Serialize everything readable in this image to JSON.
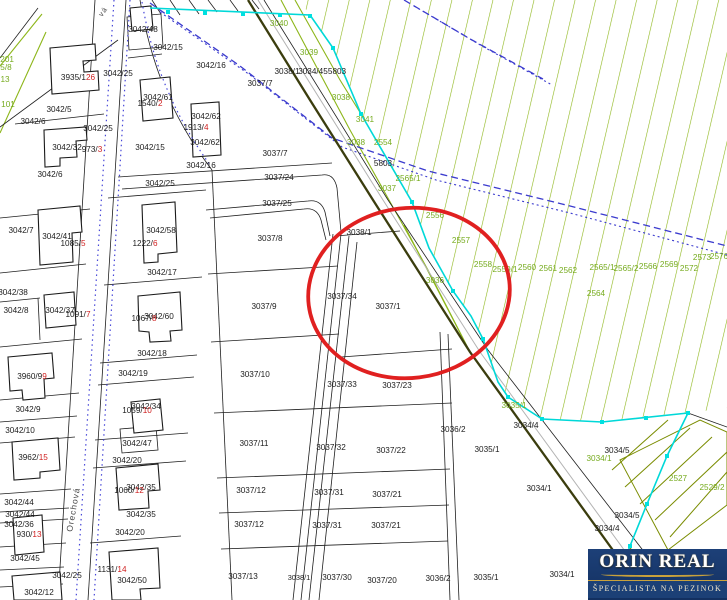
{
  "colors": {
    "parcel_line": "#1f1f1f",
    "forest_hatch": "#8db61a",
    "forest_label_green": "#76ab1e",
    "building_number_red": "#cf1f1f",
    "cadastre_boundary_cyan": "#00d8d8",
    "utility_dashed_blue": "#3b3bce",
    "road_dotted_blue": "#4646d8",
    "highlight_red": "#e02020",
    "vineyard_olive": "#7a8c00",
    "dark_path": "#3b3d0e",
    "logo_navy": "#1d4078",
    "logo_gold": "#c9a23c"
  },
  "highlight": {
    "cx": 409,
    "cy": 293,
    "rx": 101,
    "ry": 85,
    "rotation": -7,
    "color": "#e02020"
  },
  "logo": {
    "title": "ORIN REAL",
    "subtitle": "ŠPECIALISTA NA PEZINOK"
  },
  "map": {
    "labels": [
      {
        "t": "3042/48",
        "x": 143,
        "y": 32
      },
      {
        "t": "3042/15",
        "x": 168,
        "y": 50
      },
      {
        "t": "3042/16",
        "x": 211,
        "y": 68
      },
      {
        "t": "3042/25",
        "x": 118,
        "y": 76
      },
      {
        "t": "3042/5",
        "x": 59,
        "y": 112
      },
      {
        "t": "3042/6",
        "x": 33,
        "y": 124
      },
      {
        "t": "3042/25",
        "x": 98,
        "y": 131
      },
      {
        "t": "3042/61",
        "x": 158,
        "y": 100
      },
      {
        "t": "1540/",
        "rd": "2",
        "x": 150,
        "y": 106,
        "c": "m"
      },
      {
        "t": "3042/62",
        "x": 206,
        "y": 119
      },
      {
        "t": "1913/",
        "rd": "4",
        "x": 196,
        "y": 130,
        "c": "m"
      },
      {
        "t": "3042/62",
        "x": 205,
        "y": 145
      },
      {
        "t": "3042/15",
        "x": 150,
        "y": 150
      },
      {
        "t": "3042/16",
        "x": 201,
        "y": 168
      },
      {
        "t": "3042/6",
        "x": 50,
        "y": 177
      },
      {
        "t": "3042/25",
        "x": 160,
        "y": 186
      },
      {
        "t": "3935/1",
        "rd": "26",
        "x": 78,
        "y": 80,
        "c": "m"
      },
      {
        "t": "3042/32",
        "x": 67,
        "y": 150
      },
      {
        "t": "973/",
        "rd": "3",
        "x": 92,
        "y": 152,
        "c": "m"
      },
      {
        "t": "3037/7",
        "x": 260,
        "y": 86
      },
      {
        "t": "3038/1",
        "x": 287,
        "y": 74
      },
      {
        "t": "3034/45",
        "x": 313,
        "y": 74
      },
      {
        "t": "5803",
        "x": 337,
        "y": 74
      },
      {
        "t": "3037/7",
        "x": 275,
        "y": 156
      },
      {
        "t": "5803",
        "x": 383,
        "y": 166
      },
      {
        "t": "3037/24",
        "x": 279,
        "y": 180
      },
      {
        "t": "3037/25",
        "x": 277,
        "y": 206
      },
      {
        "t": "3042/7",
        "x": 21,
        "y": 233
      },
      {
        "t": "3042/41",
        "x": 57,
        "y": 239
      },
      {
        "t": "1085/",
        "rd": "5",
        "x": 73,
        "y": 246,
        "c": "m"
      },
      {
        "t": "3042/58",
        "x": 161,
        "y": 233
      },
      {
        "t": "1222/",
        "rd": "6",
        "x": 145,
        "y": 246,
        "c": "m"
      },
      {
        "t": "3042/17",
        "x": 162,
        "y": 275
      },
      {
        "t": "3042/38",
        "x": 13,
        "y": 295
      },
      {
        "t": "3042/8",
        "x": 16,
        "y": 313
      },
      {
        "t": "3042/37",
        "x": 60,
        "y": 313
      },
      {
        "t": "1091/",
        "rd": "7",
        "x": 78,
        "y": 317,
        "c": "m"
      },
      {
        "t": "3042/60",
        "x": 159,
        "y": 319
      },
      {
        "t": "1067/",
        "rd": "8",
        "x": 144,
        "y": 321,
        "c": "m"
      },
      {
        "t": "3042/18",
        "x": 152,
        "y": 356
      },
      {
        "t": "3042/19",
        "x": 133,
        "y": 376
      },
      {
        "t": "3960/9",
        "rd": "9",
        "x": 32,
        "y": 379,
        "c": "m"
      },
      {
        "t": "3042/9",
        "x": 28,
        "y": 412
      },
      {
        "t": "3042/34",
        "x": 146,
        "y": 409
      },
      {
        "t": "1059/",
        "rd": "10",
        "x": 137,
        "y": 413,
        "c": "m"
      },
      {
        "t": "3042/10",
        "x": 20,
        "y": 433
      },
      {
        "t": "3042/47",
        "x": 137,
        "y": 446
      },
      {
        "t": "3042/20",
        "x": 127,
        "y": 463
      },
      {
        "t": "3962/",
        "rd": "15",
        "x": 33,
        "y": 460,
        "c": "m"
      },
      {
        "t": "3042/35",
        "x": 141,
        "y": 490
      },
      {
        "t": "1060/",
        "rd": "12",
        "x": 129,
        "y": 493,
        "c": "m"
      },
      {
        "t": "3042/35",
        "x": 141,
        "y": 517
      },
      {
        "t": "3042/44",
        "x": 19,
        "y": 505
      },
      {
        "t": "3042/44",
        "x": 20,
        "y": 517
      },
      {
        "t": "3042/36",
        "x": 19,
        "y": 527
      },
      {
        "t": "930/",
        "rd": "13",
        "x": 29,
        "y": 537,
        "c": "m"
      },
      {
        "t": "3042/45",
        "x": 25,
        "y": 561
      },
      {
        "t": "3042/20",
        "x": 130,
        "y": 535
      },
      {
        "t": "1131/",
        "rd": "14",
        "x": 112,
        "y": 572,
        "c": "m"
      },
      {
        "t": "3042/25",
        "x": 67,
        "y": 578
      },
      {
        "t": "3042/50",
        "x": 132,
        "y": 583
      },
      {
        "t": "3042/12",
        "x": 39,
        "y": 595
      },
      {
        "t": "3037/8",
        "x": 270,
        "y": 241
      },
      {
        "t": "3038/1",
        "x": 359,
        "y": 235
      },
      {
        "t": "3037/34",
        "x": 342,
        "y": 299
      },
      {
        "t": "3037/1",
        "x": 388,
        "y": 309
      },
      {
        "t": "3037/9",
        "x": 264,
        "y": 309
      },
      {
        "t": "3037/10",
        "x": 255,
        "y": 377
      },
      {
        "t": "3037/33",
        "x": 342,
        "y": 387
      },
      {
        "t": "3037/23",
        "x": 397,
        "y": 388
      },
      {
        "t": "3037/11",
        "x": 254,
        "y": 446
      },
      {
        "t": "3037/32",
        "x": 331,
        "y": 450
      },
      {
        "t": "3037/22",
        "x": 391,
        "y": 453
      },
      {
        "t": "3037/12",
        "x": 251,
        "y": 493
      },
      {
        "t": "3037/31",
        "x": 329,
        "y": 495
      },
      {
        "t": "3037/21",
        "x": 387,
        "y": 497
      },
      {
        "t": "3037/12",
        "x": 249,
        "y": 527
      },
      {
        "t": "3037/31",
        "x": 327,
        "y": 528
      },
      {
        "t": "3037/21",
        "x": 386,
        "y": 528
      },
      {
        "t": "3037/13",
        "x": 243,
        "y": 579
      },
      {
        "t": "3038/1",
        "x": 299,
        "y": 580,
        "s": 7.4
      },
      {
        "t": "3037/30",
        "x": 337,
        "y": 580
      },
      {
        "t": "3037/20",
        "x": 382,
        "y": 583
      },
      {
        "t": "3036/2",
        "x": 453,
        "y": 432
      },
      {
        "t": "3036/2",
        "x": 438,
        "y": 581
      },
      {
        "t": "3035/1",
        "x": 487,
        "y": 452
      },
      {
        "t": "3035/1",
        "x": 486,
        "y": 580
      },
      {
        "t": "3034/4",
        "x": 526,
        "y": 428
      },
      {
        "t": "3034/5",
        "x": 617,
        "y": 453
      },
      {
        "t": "3034/1",
        "x": 539,
        "y": 491
      },
      {
        "t": "3034/5",
        "x": 627,
        "y": 518
      },
      {
        "t": "3034/4",
        "x": 607,
        "y": 531
      },
      {
        "t": "3034/1",
        "x": 562,
        "y": 577
      },
      {
        "t": "3040",
        "x": 279,
        "y": 26,
        "c": "g"
      },
      {
        "t": "3039",
        "x": 309,
        "y": 55,
        "c": "g"
      },
      {
        "t": "3038",
        "x": 341,
        "y": 100,
        "c": "g"
      },
      {
        "t": "3041",
        "x": 365,
        "y": 122,
        "c": "g"
      },
      {
        "t": "3038",
        "x": 356,
        "y": 145,
        "c": "g"
      },
      {
        "t": "2554",
        "x": 383,
        "y": 145,
        "c": "g"
      },
      {
        "t": "2565/1",
        "x": 408,
        "y": 181,
        "c": "g"
      },
      {
        "t": "3037",
        "x": 387,
        "y": 191,
        "c": "g"
      },
      {
        "t": "2556",
        "x": 435,
        "y": 218,
        "c": "g"
      },
      {
        "t": "2557",
        "x": 461,
        "y": 243,
        "c": "g"
      },
      {
        "t": "2558",
        "x": 483,
        "y": 267,
        "c": "g"
      },
      {
        "t": "2559/1",
        "x": 505,
        "y": 272,
        "c": "g"
      },
      {
        "t": "2560",
        "x": 527,
        "y": 270,
        "c": "g"
      },
      {
        "t": "2561",
        "x": 548,
        "y": 271,
        "c": "g"
      },
      {
        "t": "2562",
        "x": 568,
        "y": 273,
        "c": "g"
      },
      {
        "t": "2565/1",
        "x": 602,
        "y": 270,
        "c": "g"
      },
      {
        "t": "2565/2",
        "x": 626,
        "y": 271,
        "c": "g"
      },
      {
        "t": "2566",
        "x": 648,
        "y": 269,
        "c": "g"
      },
      {
        "t": "2569",
        "x": 669,
        "y": 267,
        "c": "g"
      },
      {
        "t": "2572",
        "x": 689,
        "y": 271,
        "c": "g"
      },
      {
        "t": "2573",
        "x": 702,
        "y": 260,
        "c": "g"
      },
      {
        "t": "2576",
        "x": 719,
        "y": 259,
        "c": "g"
      },
      {
        "t": "2564",
        "x": 596,
        "y": 296,
        "c": "g"
      },
      {
        "t": "3036",
        "x": 435,
        "y": 283,
        "c": "g"
      },
      {
        "t": "3035/1",
        "x": 514,
        "y": 408,
        "c": "g"
      },
      {
        "t": "3034/1",
        "x": 599,
        "y": 461,
        "c": "g"
      },
      {
        "t": "2527",
        "x": 678,
        "y": 481,
        "c": "g"
      },
      {
        "t": "2529/2",
        "x": 712,
        "y": 490,
        "c": "g"
      },
      {
        "t": "/201",
        "x": 6,
        "y": 62,
        "c": "g"
      },
      {
        "t": "5/8",
        "x": 6,
        "y": 70,
        "c": "g"
      },
      {
        "t": "13",
        "x": 5,
        "y": 82,
        "c": "g"
      },
      {
        "t": "101",
        "x": 8,
        "y": 107,
        "c": "g"
      },
      {
        "t": "Orechová",
        "x": 76,
        "y": 510,
        "c": "s",
        "r": -80,
        "s": 8.5
      },
      {
        "t": "vá",
        "x": 105,
        "y": 13,
        "c": "s",
        "r": -55,
        "s": 7.5
      }
    ]
  }
}
